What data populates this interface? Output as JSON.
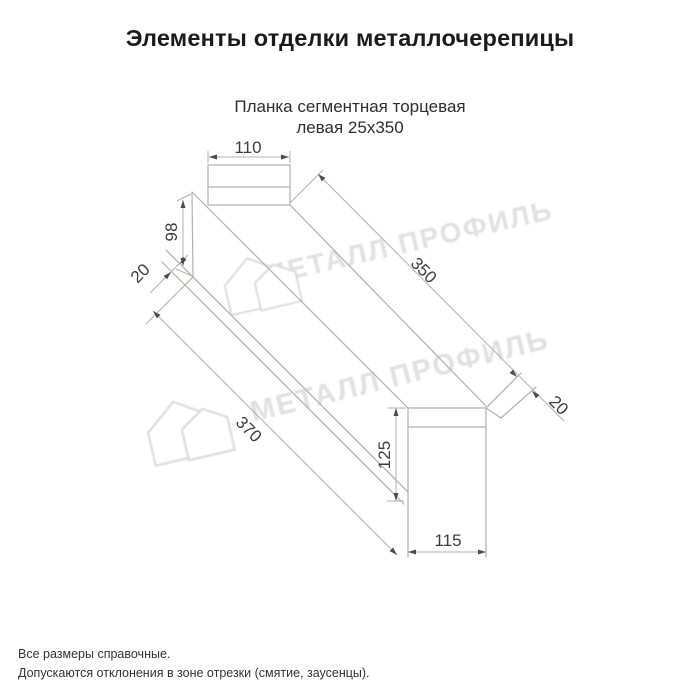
{
  "page": {
    "title": "Элементы отделки металлочерепицы"
  },
  "product": {
    "subtitle_line1": "Планка сегментная торцевая",
    "subtitle_line2": "левая 25х350"
  },
  "watermark": {
    "text": "МЕТАЛЛ ПРОФИЛЬ"
  },
  "drawing": {
    "type": "technical-dimension-drawing",
    "labels": {
      "width_top": "110",
      "height_left": "98",
      "hem_left": "20",
      "length_top": "350",
      "length_bottom": "370",
      "hem_right": "20",
      "height_right": "125",
      "width_bottom": "115"
    }
  },
  "footer": {
    "note1": "Все размеры справочные.",
    "note2": "Допускаются отклонения в зоне отрезки (смятие, заусенцы)."
  },
  "colors": {
    "line": "#b3b1ae",
    "dim_text": "#3c3c3c",
    "arrow": "#4c4c4c",
    "watermark": "#e1e1e1",
    "title": "#1b1b1b"
  }
}
